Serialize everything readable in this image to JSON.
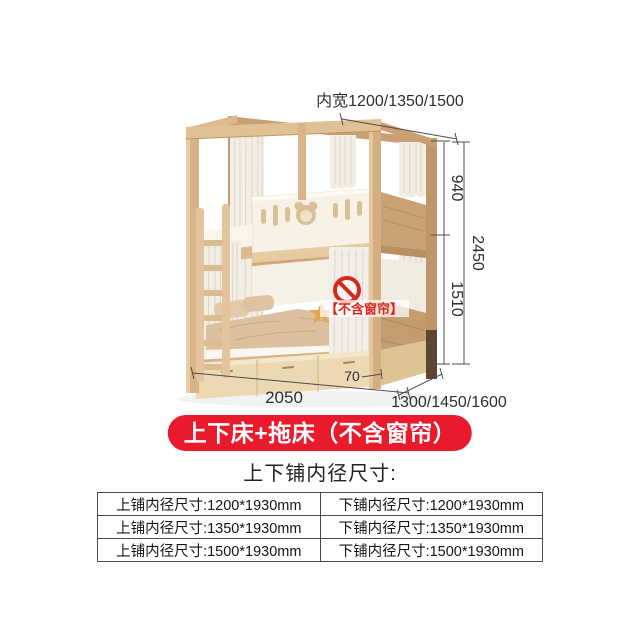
{
  "diagram": {
    "top_width_label": "内宽1200/1350/1500",
    "dim_upper_height": "940",
    "dim_total_height": "2450",
    "dim_lower_height": "1510",
    "dim_length": "2050",
    "dim_drawer_offset": "70",
    "dim_depth": "1300/1450/1600",
    "no_curtain_tag": "【不含窗帘】"
  },
  "badge": {
    "label": "上下床+拖床（不含窗帘）",
    "bg_color": "#e81a2b",
    "text_color": "#ffffff"
  },
  "section": {
    "heading": "上下铺内径尺寸:"
  },
  "table": {
    "rows": [
      [
        "上铺内径尺寸:1200*1930mm",
        "下铺内径尺寸:1200*1930mm"
      ],
      [
        "上铺内径尺寸:1350*1930mm",
        "下铺内径尺寸:1350*1930mm"
      ],
      [
        "上铺内径尺寸:1500*1930mm",
        "下铺内径尺寸:1500*1930mm"
      ]
    ]
  },
  "colors": {
    "warning_red": "#d6281f",
    "wood_main": "#d2ab7e",
    "table_border": "#4a4a4a"
  }
}
